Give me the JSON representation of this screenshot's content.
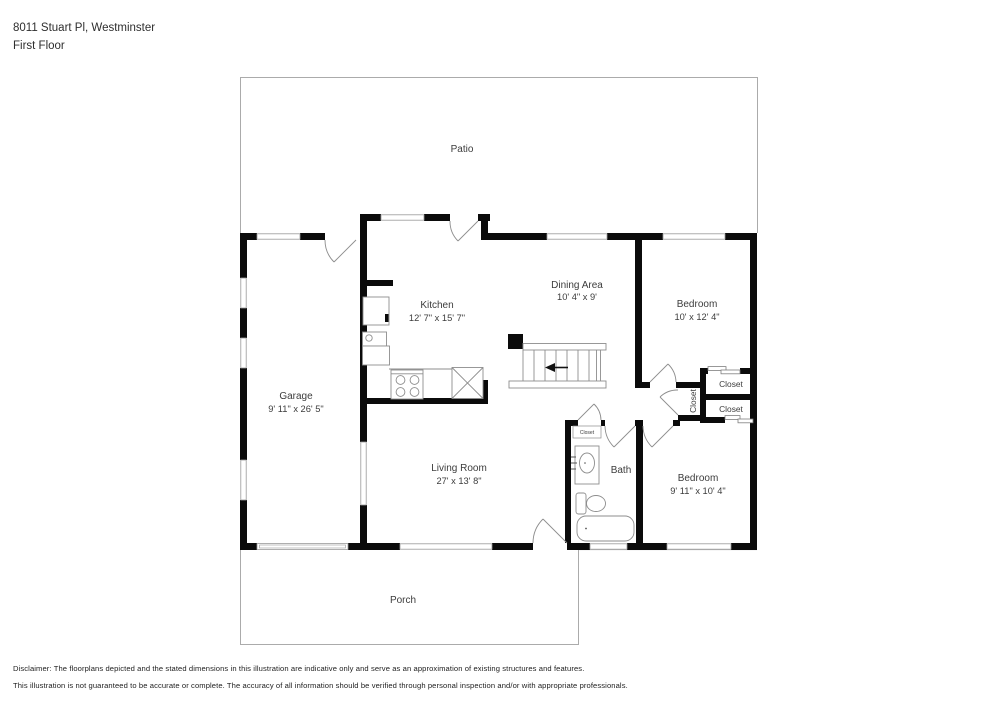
{
  "header": {
    "address": "8011 Stuart Pl, Westminster",
    "floor": "First Floor"
  },
  "rooms": {
    "patio": {
      "name": "Patio"
    },
    "porch": {
      "name": "Porch"
    },
    "garage": {
      "name": "Garage",
      "dims": "9' 11\" x 26' 5\""
    },
    "kitchen": {
      "name": "Kitchen",
      "dims": "12' 7\" x 15' 7\""
    },
    "dining": {
      "name": "Dining Area",
      "dims": "10' 4\" x 9'"
    },
    "bedroom1": {
      "name": "Bedroom",
      "dims": "10' x 12' 4\""
    },
    "living": {
      "name": "Living Room",
      "dims": "27' x 13' 8\""
    },
    "bath": {
      "name": "Bath"
    },
    "bedroom2": {
      "name": "Bedroom",
      "dims": "9' 11\" x 10' 4\""
    },
    "closet_top_right": {
      "name": "Closet"
    },
    "closet_bottom_right": {
      "name": "Closet"
    },
    "closet_hall": {
      "name": "Closet"
    },
    "closet_bath": {
      "name": "Closet"
    }
  },
  "disclaimer": {
    "line1": "Disclaimer: The floorplans depicted and the stated dimensions in this illustration are indicative only and serve as an approximation of existing structures and features.",
    "line2": "This illustration is not guaranteed to be accurate or complete. The accuracy of all information should be verified through personal inspection and/or with appropriate professionals."
  },
  "colors": {
    "wall": "#0b0b0b",
    "thin": "#a3a3a3",
    "text": "#3c3c3c"
  }
}
